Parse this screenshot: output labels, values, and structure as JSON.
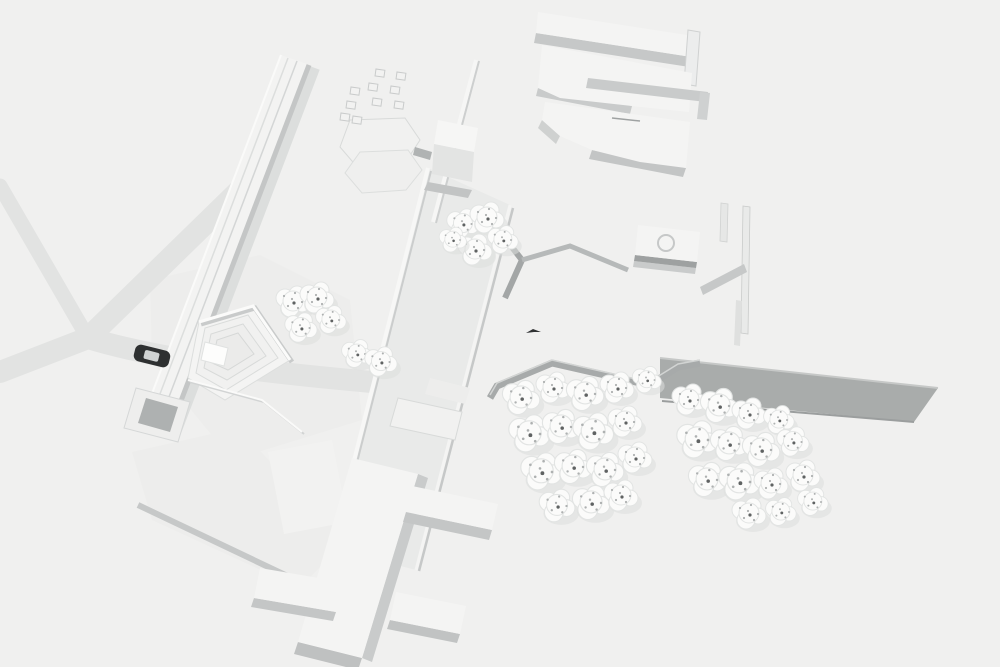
{
  "scene": {
    "description": "Aerial oblique render of an all-white architectural site model with soft gray shadows",
    "style": "monochrome massing model",
    "width": 1000,
    "height": 667
  },
  "palette": {
    "background": "#f0f0ef",
    "road": "#e2e3e2",
    "plaza": "#ededec",
    "boulevard": "#e9eae9",
    "building_top": "#f4f4f3",
    "building_side": "#dfe0df",
    "parapet_white": "#fafaf9",
    "shadow_soft": "#cbcdcd",
    "shadow_mid": "#b9bcbc",
    "wall_dark": "#a3a6a6",
    "embankment": "#a9acab",
    "tree_fill": "#fbfbfa",
    "tree_stroke": "#e2e4e3",
    "tree_shadow": "#dcdedd",
    "speck": "#aeb1b1",
    "speck_dark": "#5f6262",
    "car_body": "#2e3031",
    "car_glass": "#d0d3d3",
    "bird": "#2f3132"
  },
  "features": {
    "roads": {
      "label": "Y-shaped road fork",
      "branch_count": 4
    },
    "car": {
      "label": "single dark car on road",
      "count": 1
    },
    "amphitheater": {
      "label": "pentagonal terraced plaza with square stage"
    },
    "linear_building": {
      "label": "long narrow diagonal bar building"
    },
    "central_boulevard": {
      "label": "wide pedestrian spine with parapet walls"
    },
    "comb_building": {
      "label": "bar building with perpendicular wings"
    },
    "slab_buildings": {
      "label": "flat slab building cluster, top right"
    },
    "pavilion": {
      "label": "square pavilion with circular roof oculus"
    },
    "cube_building": {
      "label": "small cube building"
    },
    "hex_pavilions": {
      "label": "two overlapping hexagonal pads"
    },
    "block_grid": {
      "label": "scatter grid of small cubes"
    },
    "embankment": {
      "label": "gray sloped embankment wall"
    },
    "zigzag_wall": {
      "label": "zigzag perimeter wall along grove"
    },
    "bird": {
      "label": "tiny dark bird figure",
      "count": 1
    },
    "tree_total_count": 41
  },
  "blocks": [
    [
      376,
      69
    ],
    [
      397,
      72
    ],
    [
      369,
      83
    ],
    [
      391,
      86
    ],
    [
      351,
      87
    ],
    [
      373,
      98
    ],
    [
      395,
      101
    ],
    [
      347,
      101
    ],
    [
      341,
      113
    ],
    [
      353,
      116
    ]
  ],
  "trees": {
    "grove_left": [
      [
        520,
        398,
        1.1
      ],
      [
        552,
        388,
        1.0
      ],
      [
        584,
        394,
        1.1
      ],
      [
        616,
        388,
        1.0
      ],
      [
        646,
        380,
        0.85
      ],
      [
        528,
        434,
        1.2
      ],
      [
        560,
        427,
        1.1
      ],
      [
        592,
        432,
        1.2
      ],
      [
        624,
        422,
        1.0
      ],
      [
        540,
        472,
        1.2
      ],
      [
        572,
        467,
        1.1
      ],
      [
        604,
        470,
        1.1
      ],
      [
        634,
        458,
        1.0
      ],
      [
        556,
        506,
        1.05
      ],
      [
        590,
        503,
        1.1
      ],
      [
        620,
        496,
        1.0
      ]
    ],
    "grove_right": [
      [
        688,
        400,
        1.0
      ],
      [
        718,
        406,
        1.1
      ],
      [
        748,
        414,
        1.0
      ],
      [
        778,
        420,
        0.9
      ],
      [
        696,
        440,
        1.2
      ],
      [
        728,
        444,
        1.1
      ],
      [
        760,
        450,
        1.1
      ],
      [
        792,
        442,
        0.95
      ],
      [
        706,
        480,
        1.1
      ],
      [
        738,
        482,
        1.2
      ],
      [
        770,
        484,
        1.0
      ],
      [
        802,
        476,
        1.0
      ],
      [
        748,
        514,
        1.0
      ],
      [
        780,
        512,
        0.9
      ],
      [
        812,
        502,
        0.9
      ]
    ],
    "cluster_center": [
      [
        462,
        224,
        0.95
      ],
      [
        486,
        218,
        1.0
      ],
      [
        502,
        240,
        0.9
      ],
      [
        474,
        250,
        1.0
      ],
      [
        452,
        240,
        0.8
      ]
    ],
    "cluster_west": [
      [
        292,
        302,
        1.0
      ],
      [
        316,
        298,
        1.0
      ],
      [
        330,
        320,
        0.9
      ],
      [
        300,
        328,
        0.95
      ]
    ],
    "cluster_pair": [
      [
        356,
        354,
        0.9
      ],
      [
        380,
        362,
        0.95
      ]
    ]
  }
}
